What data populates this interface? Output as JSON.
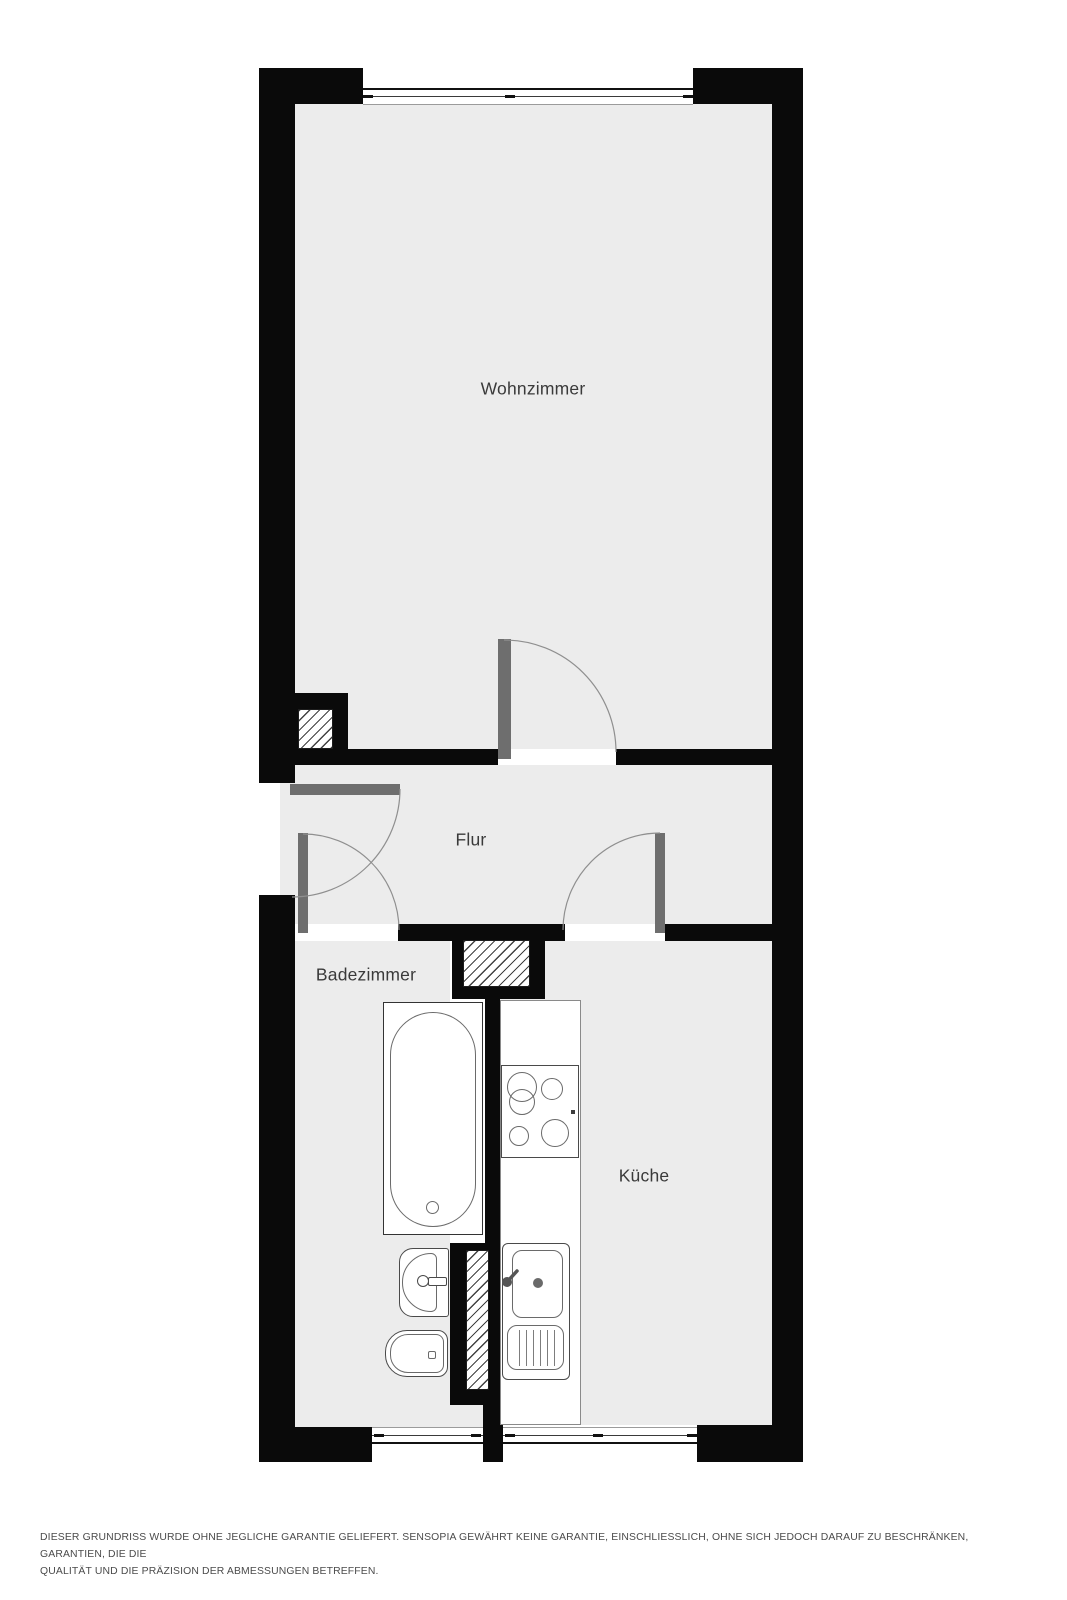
{
  "plan": {
    "title": "floor-plan",
    "rooms": [
      {
        "id": "wohnzimmer",
        "label": "Wohnzimmer"
      },
      {
        "id": "flur",
        "label": "Flur"
      },
      {
        "id": "badezimmer",
        "label": "Badezimmer"
      },
      {
        "id": "kueche",
        "label": "Küche"
      }
    ],
    "fixtures": [
      "bathtub",
      "washbasin",
      "bidet",
      "kitchen-counter",
      "stove",
      "kitchen-sink"
    ],
    "colors": {
      "wall": "#0a0a0a",
      "floor": "#ececec",
      "door_leaf": "#6e6e6e",
      "arc_line": "#8f8f8f",
      "fixture_line": "#4a4a4a",
      "label_text": "#3a3a3a",
      "disclaimer_text": "#4b4b4b"
    }
  },
  "disclaimer": {
    "line1": "DIESER GRUNDRISS WURDE OHNE JEGLICHE GARANTIE GELIEFERT. SENSOPIA GEWÄHRT KEINE GARANTIE, EINSCHLIESSLICH, OHNE SICH JEDOCH DARAUF ZU BESCHRÄNKEN, GARANTIEN, DIE DIE",
    "line2": "QUALITÄT UND DIE PRÄZISION DER ABMESSUNGEN BETREFFEN."
  }
}
